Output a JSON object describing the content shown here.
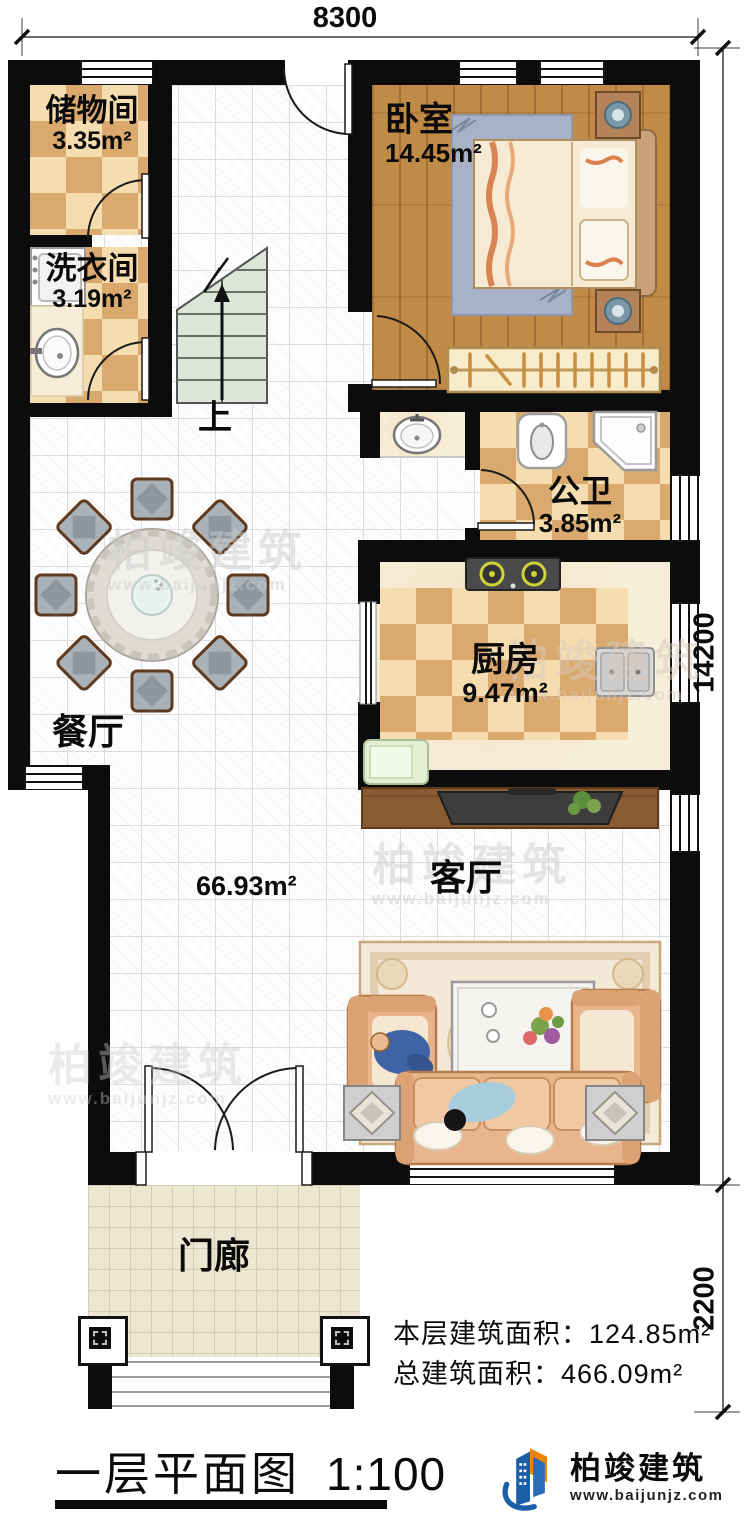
{
  "dims": {
    "top": "8300",
    "right_main": "14200",
    "right_porch": "2200"
  },
  "rooms": {
    "storage": {
      "name": "储物间",
      "area": "3.35m²"
    },
    "laundry": {
      "name": "洗衣间",
      "area": "3.19m²"
    },
    "bedroom": {
      "name": "卧室",
      "area": "14.45m²"
    },
    "bathroom": {
      "name": "公卫",
      "area": "3.85m²"
    },
    "kitchen": {
      "name": "厨房",
      "area": "9.47m²"
    },
    "dining": {
      "name": "餐厅"
    },
    "living": {
      "name": "客厅"
    },
    "hall": {
      "area": "66.93m²"
    },
    "porch": {
      "name": "门廊"
    },
    "stairs": {
      "up_label": "上"
    }
  },
  "stats": {
    "floor": "本层建筑面积：124.85m²",
    "total": "总建筑面积：466.09m²"
  },
  "titleblock": {
    "title": "一层平面图",
    "scale": "1:100"
  },
  "brand": {
    "name": "柏竣建筑",
    "site": "www.baijunjz.com"
  },
  "watermark": {
    "name": "柏竣建筑",
    "site": "www.baijunjz.com"
  },
  "colors": {
    "logo_blue": "#1b5fa8",
    "logo_orange": "#f08300",
    "wall": "#0c0c0c"
  }
}
